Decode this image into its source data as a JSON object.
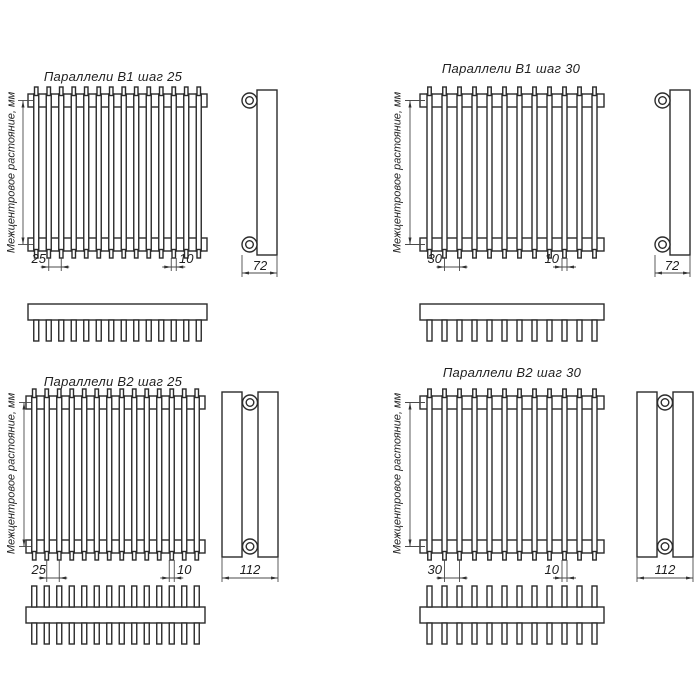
{
  "sheet": {
    "background": "#ffffff",
    "line_color": "#2b2b2b",
    "thin_line_color": "#4a4a4a"
  },
  "drawings": [
    {
      "id": "b1-step-25",
      "title": "Параллели В1 шаг 25",
      "center_distance_label": "Межцентровое растояние, мм",
      "step_dim": "25",
      "tube_width_dim": "10",
      "depth_dim": "72",
      "rows": 1,
      "tube_count": 14,
      "pitch_mm": 25,
      "tube_width_mm": 10,
      "depth_mm": 72
    },
    {
      "id": "b1-step-30",
      "title": "Параллели В1 шаг 30",
      "center_distance_label": "Межцентровое растояние, мм",
      "step_dim": "30",
      "tube_width_dim": "10",
      "depth_dim": "72",
      "rows": 1,
      "tube_count": 12,
      "pitch_mm": 30,
      "tube_width_mm": 10,
      "depth_mm": 72
    },
    {
      "id": "b2-step-25",
      "title": "Параллели В2 шаг 25",
      "center_distance_label": "Межцентровое растояние, мм",
      "step_dim": "25",
      "tube_width_dim": "10",
      "depth_dim": "112",
      "rows": 2,
      "tube_count": 14,
      "pitch_mm": 25,
      "tube_width_mm": 10,
      "depth_mm": 112
    },
    {
      "id": "b2-step-30",
      "title": "Параллели В2 шаг 30",
      "center_distance_label": "Межцентровое растояние, мм",
      "step_dim": "30",
      "tube_width_dim": "10",
      "depth_dim": "112",
      "rows": 2,
      "tube_count": 12,
      "pitch_mm": 30,
      "tube_width_mm": 10,
      "depth_mm": 112
    }
  ]
}
